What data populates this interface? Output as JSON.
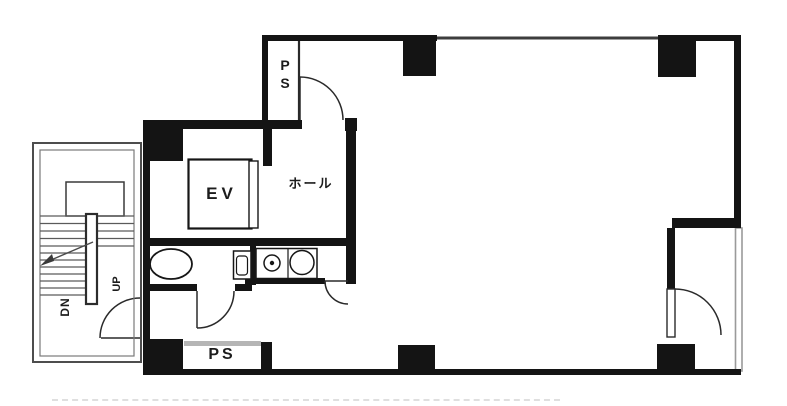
{
  "diagram": {
    "type": "architectural-floor-plan",
    "labels": {
      "elevator": "EV",
      "hall": "ホール",
      "pipe_shaft_top": "PS",
      "pipe_shaft_bottom": "PS",
      "stairs_up": "UP",
      "stairs_down": "DN"
    },
    "rooms": [
      {
        "name": "elevator-shaft",
        "label": "EV"
      },
      {
        "name": "elevator-hall",
        "label": "ホール"
      },
      {
        "name": "pipe-shaft-top",
        "label": "PS"
      },
      {
        "name": "pipe-shaft-bottom",
        "label": "PS"
      },
      {
        "name": "staircase",
        "labels": [
          "UP",
          "DN"
        ]
      },
      {
        "name": "wc",
        "label": ""
      },
      {
        "name": "kitchenette",
        "label": ""
      },
      {
        "name": "main-room",
        "label": ""
      },
      {
        "name": "balcony-alcove",
        "label": ""
      }
    ]
  },
  "colors": {
    "wall": "#141414",
    "line": "#2a2a2a",
    "stair": "#4d4d4d",
    "window": "#9a9a9a",
    "hatch": "#b5b5b5",
    "background": "#ffffff",
    "text": "#1c1c1c"
  }
}
